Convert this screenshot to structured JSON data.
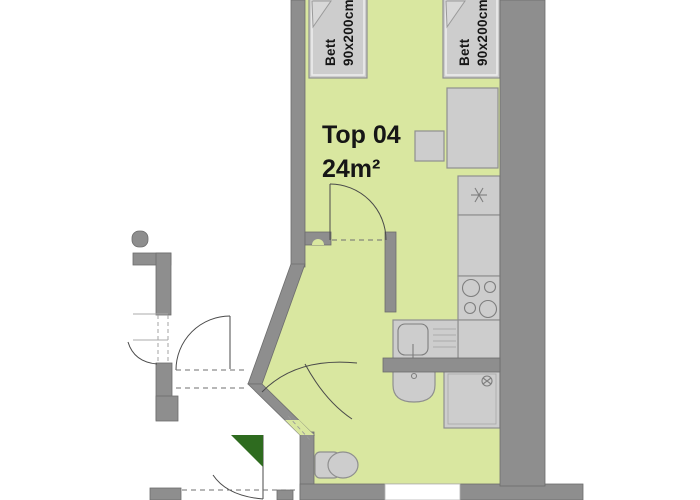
{
  "floorplan": {
    "unit": {
      "label": "Top 04",
      "area": "24m²"
    },
    "beds": [
      {
        "label": "Bett",
        "size": "90x200cm"
      },
      {
        "label": "Bett",
        "size": "90x200cm"
      }
    ],
    "colors": {
      "floor": "#d9e7a0",
      "wall": "#8e8e8e",
      "furniture": "#cdcdcd",
      "entrance_marker": "#2e6b1f"
    }
  }
}
